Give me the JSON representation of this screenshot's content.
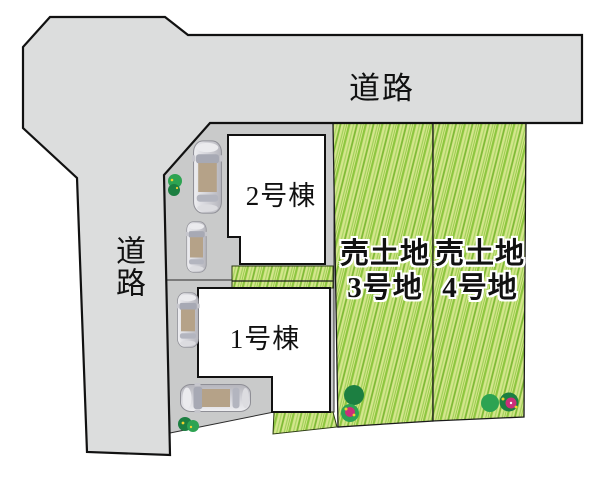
{
  "roads": {
    "top_label": "道路",
    "left_label": "道路"
  },
  "buildings": [
    {
      "id": "building-2",
      "label": "2号棟"
    },
    {
      "id": "building-1",
      "label": "1号棟"
    }
  ],
  "lots": [
    {
      "id": "lot-3",
      "line1": "売土地",
      "line2": "3号地"
    },
    {
      "id": "lot-4",
      "line1": "売土地",
      "line2": "4号地"
    }
  ],
  "colors": {
    "road": "#dcdddd",
    "parking": "#c9caca",
    "building": "#ffffff",
    "grass_base": "#d4e68c",
    "grass_stripe_1": "#8dc63f",
    "grass_stripe_2": "#a6d55f",
    "grass_stripe_3": "#7db934",
    "grass_stripe_4": "#9ccf55",
    "outline": "#1a1a1a",
    "bush_dark": "#1c7f41",
    "bush_mid": "#2da352",
    "flower_pink": "#cb2f7a",
    "flower_yellow": "#f0d22e",
    "car_body_light": "#efeff2",
    "car_body_dark": "#b5b5bc",
    "car_roof": "#b5a288",
    "car_glass": "#a7a9b4"
  }
}
